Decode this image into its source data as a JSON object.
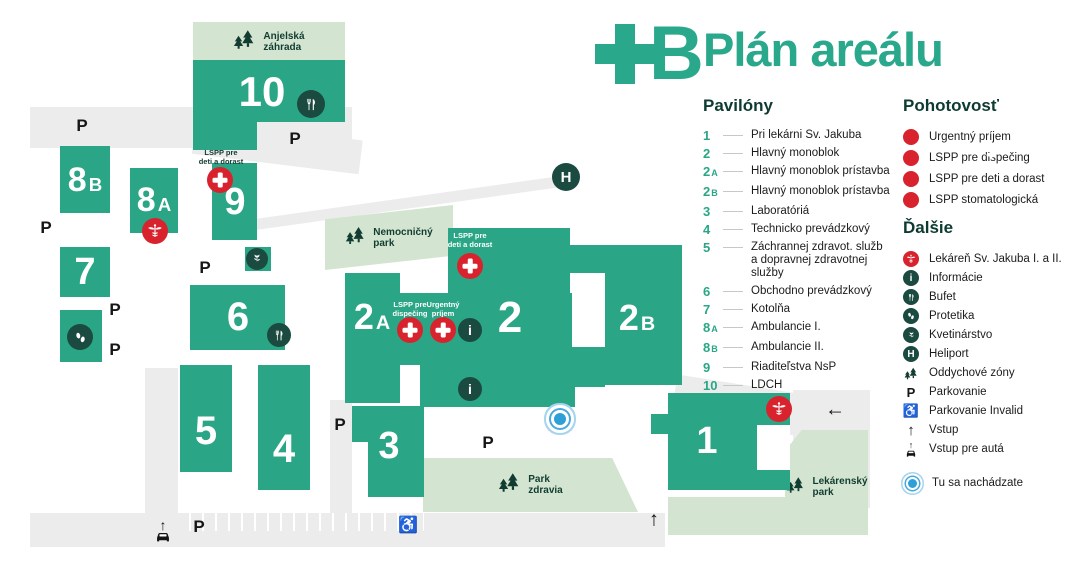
{
  "title": "Plán areálu",
  "brand_letter": "B",
  "colors": {
    "teal": "#2aa686",
    "dark_green": "#1b4a40",
    "park_green": "#d3e5d0",
    "road_gray": "#ececec",
    "red": "#d8232e",
    "blue": "#2f9fd8",
    "title_green": "#2aa88c",
    "text": "#1b1b1a"
  },
  "map": {
    "parking_letter": "P",
    "glyphs": {
      "up": "↑",
      "left": "←",
      "wheelchair": "♿",
      "info": "i",
      "heliport": "H"
    },
    "buildings": {
      "b10": {
        "num": "10"
      },
      "b9": {
        "num": "9"
      },
      "b8a": {
        "num": "8",
        "suffix": "A"
      },
      "b8b": {
        "num": "8",
        "suffix": "B"
      },
      "b7": {
        "num": "7"
      },
      "b6": {
        "num": "6"
      },
      "b5": {
        "num": "5"
      },
      "b4": {
        "num": "4"
      },
      "b3": {
        "num": "3"
      },
      "b2a": {
        "num": "2",
        "suffix": "A"
      },
      "b2": {
        "num": "2"
      },
      "b2b": {
        "num": "2",
        "suffix": "B"
      },
      "b1": {
        "num": "1"
      }
    },
    "parks": {
      "anjelska": [
        "Anjelská",
        "záhrada"
      ],
      "nemocnicny": [
        "Nemocničný",
        "park"
      ],
      "zdravia": [
        "Park",
        "zdravia"
      ],
      "lekarensky": [
        "Lekárenský",
        "park"
      ]
    },
    "overlays": {
      "lspp_deti": [
        "LSPP pre",
        "deti a dorast"
      ],
      "lspp_disp": [
        "LSPP pre",
        "dispečing"
      ],
      "urgent": [
        "Urgentný",
        "príjem"
      ]
    }
  },
  "legend": {
    "pavilony": {
      "title": "Pavilóny",
      "items": [
        {
          "num": "1",
          "suffix": "",
          "label": "Pri lekárni Sv. Jakuba"
        },
        {
          "num": "2",
          "suffix": "",
          "label": "Hlavný monoblok"
        },
        {
          "num": "2",
          "suffix": "A",
          "label": "Hlavný monoblok prístavba"
        },
        {
          "num": "2",
          "suffix": "B",
          "label": "Hlavný monoblok prístavba"
        },
        {
          "num": "3",
          "suffix": "",
          "label": "Laboratóriá"
        },
        {
          "num": "4",
          "suffix": "",
          "label": "Technicko prevádzkový"
        },
        {
          "num": "5",
          "suffix": "",
          "label": "Záchrannej zdravot. služb",
          "label2": "a dopravnej zdravotnej služby"
        },
        {
          "num": "6",
          "suffix": "",
          "label": "Obchodno prevádzkový"
        },
        {
          "num": "7",
          "suffix": "",
          "label": "Kotolňa"
        },
        {
          "num": "8",
          "suffix": "A",
          "label": "Ambulancie I."
        },
        {
          "num": "8",
          "suffix": "B",
          "label": "Ambulancie II."
        },
        {
          "num": "9",
          "suffix": "",
          "label": "Riaditeľstva NsP"
        },
        {
          "num": "10",
          "suffix": "",
          "label": "LDCH"
        }
      ]
    },
    "pohotovost": {
      "title": "Pohotovosť",
      "items": [
        {
          "icon": "emergency-cross",
          "label": "Urgentný príjem"
        },
        {
          "icon": "emergency-cross",
          "label": "LSPP pre dispečing"
        },
        {
          "icon": "emergency-cross",
          "label": "LSPP pre deti a dorast"
        },
        {
          "icon": "emergency-cross",
          "label": "LSPP stomatologická"
        }
      ]
    },
    "dalsie": {
      "title": "Ďalšie",
      "items": [
        {
          "icon": "pharmacy",
          "label": "Lekáreň Sv. Jakuba I. a II."
        },
        {
          "icon": "info",
          "label": "Informácie"
        },
        {
          "icon": "fork-knife",
          "label": "Bufet"
        },
        {
          "icon": "footprints",
          "label": "Protetika"
        },
        {
          "icon": "flower",
          "label": "Kvetinárstvo"
        },
        {
          "icon": "heliport",
          "label": "Heliport"
        },
        {
          "icon": "tree",
          "label": "Oddychové zóny"
        },
        {
          "icon": "parking",
          "label": "Parkovanie"
        },
        {
          "icon": "wheelchair",
          "label": "Parkovanie Invalid"
        },
        {
          "icon": "arrow-up",
          "label": "Vstup"
        },
        {
          "icon": "car-entrance",
          "label": "Vstup pre autá"
        }
      ],
      "you_are_here": "Tu sa nachádzate"
    }
  }
}
